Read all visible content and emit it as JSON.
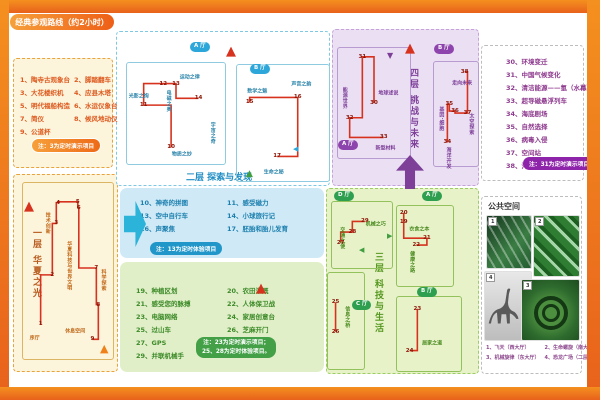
{
  "title": "经典参观路线（约2小时）",
  "colors": {
    "frame": "#e8611c",
    "route": "#d6321e",
    "blue": "#2da7d9",
    "green": "#2e9e4f",
    "purple": "#8e44ad",
    "orange": "#f08119"
  },
  "floor1": {
    "title": "一层 华夏之光",
    "items": [
      {
        "n": "1",
        "t": "陶寺古观象台"
      },
      {
        "n": "2",
        "t": "脚踏翻车"
      },
      {
        "n": "3",
        "t": "大花楼织机"
      },
      {
        "n": "4",
        "t": "应县木塔"
      },
      {
        "n": "5",
        "t": "明代福船构造"
      },
      {
        "n": "6",
        "t": "水运仪象台"
      },
      {
        "n": "7",
        "t": "简仪"
      },
      {
        "n": "8",
        "t": "候风地动仪"
      },
      {
        "n": "9",
        "t": "公道杯"
      }
    ],
    "note": "注：3为定时演示项目"
  },
  "floor2": {
    "title": "二层 探索与发现",
    "items": [
      {
        "n": "10",
        "t": "神奇的拼图"
      },
      {
        "n": "11",
        "t": "感受磁力"
      },
      {
        "n": "13",
        "t": "空中自行车"
      },
      {
        "n": "14",
        "t": "小球旅行记"
      },
      {
        "n": "16",
        "t": "声聚焦"
      },
      {
        "n": "17",
        "t": "胚胎和胎儿发育"
      }
    ],
    "note": "注：13为定时体验项目"
  },
  "floor3": {
    "title": "三层 科技与生活",
    "items": [
      {
        "n": "19",
        "t": "种植区划"
      },
      {
        "n": "20",
        "t": "农田灌溉"
      },
      {
        "n": "21",
        "t": "感受您的脉搏"
      },
      {
        "n": "22",
        "t": "人体保卫战"
      },
      {
        "n": "23",
        "t": "电脑网络"
      },
      {
        "n": "24",
        "t": "家居创意台"
      },
      {
        "n": "25",
        "t": "过山车"
      },
      {
        "n": "26",
        "t": "芝麻开门"
      },
      {
        "n": "27",
        "t": "GPS"
      },
      {
        "n": "28",
        "t": "螺旋推进器"
      },
      {
        "n": "29",
        "t": "并联机械手"
      }
    ],
    "note1": "注：23为定时演示项目；",
    "note2": "25、28为定时体验项目。"
  },
  "floor4": {
    "title": "四层 挑战与未来",
    "items": [
      {
        "n": "30",
        "t": "环境变迁"
      },
      {
        "n": "31",
        "t": "中国气候变化"
      },
      {
        "n": "32",
        "t": "清洁能源——氢（水幕）"
      },
      {
        "n": "33",
        "t": "超导磁悬浮列车"
      },
      {
        "n": "34",
        "t": "海底剧场"
      },
      {
        "n": "35",
        "t": "自然选择"
      },
      {
        "n": "36",
        "t": "病毒入侵"
      },
      {
        "n": "37",
        "t": "空间站"
      },
      {
        "n": "38",
        "t": "沟通世界"
      }
    ],
    "note": "注：31为定时演示项目"
  },
  "public_space": {
    "title": "公共空间",
    "captions": [
      "1、飞天（西大厅）",
      "2、生命螺旋（南大厅）",
      "3、机械旋律（东大厅）",
      "4、恐龙广场（二层中央大厅）"
    ],
    "photo_tags": [
      "1",
      "2",
      "4",
      "3"
    ]
  },
  "plans": [
    {
      "id": "f1",
      "stops": [
        {
          "n": "1",
          "x": 19.6,
          "y": 80.3
        },
        {
          "n": "2",
          "x": 32.6,
          "y": 52.2
        },
        {
          "n": "3",
          "x": 37,
          "y": 23
        },
        {
          "n": "4",
          "x": 39.1,
          "y": 11.2
        },
        {
          "n": "5",
          "x": 60.9,
          "y": 10.7
        },
        {
          "n": "6",
          "x": 62,
          "y": 14
        },
        {
          "n": "7",
          "x": 81.5,
          "y": 48.3
        },
        {
          "n": "8",
          "x": 83.7,
          "y": 69.1
        },
        {
          "n": "9",
          "x": 77.2,
          "y": 88.8
        }
      ],
      "labels": [
        {
          "t": "技术创新",
          "x": 28,
          "y": 23,
          "v": 1
        },
        {
          "t": "华夏科技与世界文明",
          "x": 52,
          "y": 47,
          "v": 1
        },
        {
          "t": "科学探索",
          "x": 90,
          "y": 55,
          "v": 1
        },
        {
          "t": "序厅",
          "x": 13,
          "y": 88
        },
        {
          "t": "休息空间",
          "x": 58,
          "y": 84
        }
      ]
    },
    {
      "id": "f2a",
      "stops": [
        {
          "n": "10",
          "x": 45,
          "y": 83.5
        },
        {
          "n": "11",
          "x": 17,
          "y": 41.7
        },
        {
          "n": "12",
          "x": 37,
          "y": 20.4
        },
        {
          "n": "13",
          "x": 50,
          "y": 20.4
        },
        {
          "n": "14",
          "x": 73,
          "y": 35
        }
      ],
      "labels": [
        {
          "t": "光影之绚",
          "x": 12,
          "y": 33
        },
        {
          "t": "电磁之奥",
          "x": 43,
          "y": 38,
          "v": 1
        },
        {
          "t": "运动之律",
          "x": 64,
          "y": 14
        },
        {
          "t": "宇宙之奇",
          "x": 88,
          "y": 69,
          "v": 1
        },
        {
          "t": "物质之妙",
          "x": 56,
          "y": 90
        }
      ]
    },
    {
      "id": "f2b",
      "stops": [
        {
          "n": "15",
          "x": 13.8,
          "y": 32.2
        },
        {
          "n": "16",
          "x": 66,
          "y": 28
        },
        {
          "n": "17",
          "x": 43.6,
          "y": 78.8
        }
      ],
      "labels": [
        {
          "t": "数学之魅",
          "x": 22,
          "y": 22
        },
        {
          "t": "声音之韵",
          "x": 70,
          "y": 16
        },
        {
          "t": "生命之秘",
          "x": 40,
          "y": 92
        }
      ]
    },
    {
      "id": "f3d",
      "stops": [
        {
          "n": "27",
          "x": 14.5,
          "y": 61.8
        },
        {
          "n": "28",
          "x": 33.9,
          "y": 45.6
        },
        {
          "n": "29",
          "x": 54.8,
          "y": 29.4
        }
      ],
      "labels": [
        {
          "t": "机械之巧",
          "x": 73,
          "y": 33
        },
        {
          "t": "交通之便",
          "x": 18,
          "y": 55,
          "v": 1
        }
      ]
    },
    {
      "id": "f3a",
      "stops": [
        {
          "n": "19",
          "x": 12,
          "y": 19.5
        },
        {
          "n": "20",
          "x": 12,
          "y": 8.5
        },
        {
          "n": "21",
          "x": 53.4,
          "y": 40.2
        },
        {
          "n": "22",
          "x": 34.5,
          "y": 48.8
        }
      ],
      "labels": [
        {
          "t": "衣食之本",
          "x": 40,
          "y": 29
        },
        {
          "t": "健康之路",
          "x": 28,
          "y": 70,
          "v": 1
        }
      ]
    },
    {
      "id": "f3b",
      "stops": [
        {
          "n": "23",
          "x": 31.8,
          "y": 15.8
        },
        {
          "n": "24",
          "x": 19.7,
          "y": 72.4
        }
      ],
      "labels": [
        {
          "t": "居家之道",
          "x": 55,
          "y": 62
        }
      ]
    },
    {
      "id": "f3c",
      "stops": [
        {
          "n": "25",
          "x": 21,
          "y": 30.6
        },
        {
          "n": "26",
          "x": 21,
          "y": 61.2
        }
      ],
      "labels": [
        {
          "t": "信息之桥",
          "x": 55,
          "y": 46,
          "v": 1
        }
      ]
    },
    {
      "id": "f4a",
      "stops": [
        {
          "n": "30",
          "x": 50,
          "y": 50
        },
        {
          "n": "31",
          "x": 33.8,
          "y": 8
        },
        {
          "n": "32",
          "x": 16.2,
          "y": 63.4
        },
        {
          "n": "33",
          "x": 63.5,
          "y": 81.3
        }
      ],
      "labels": [
        {
          "t": "能源世界",
          "x": 10,
          "y": 45,
          "v": 1
        },
        {
          "t": "地球述说",
          "x": 70,
          "y": 41
        },
        {
          "t": "新型材料",
          "x": 66,
          "y": 91
        }
      ]
    },
    {
      "id": "f4b",
      "stops": [
        {
          "n": "34",
          "x": 30.4,
          "y": 77.4
        },
        {
          "n": "35",
          "x": 34.8,
          "y": 40.6
        },
        {
          "n": "36",
          "x": 47.8,
          "y": 47.2
        },
        {
          "n": "37",
          "x": 76.1,
          "y": 49.1
        },
        {
          "n": "38",
          "x": 69.6,
          "y": 9.4
        }
      ],
      "labels": [
        {
          "t": "走向未来",
          "x": 64,
          "y": 20
        },
        {
          "t": "基因·细胞",
          "x": 18,
          "y": 55,
          "v": 1
        },
        {
          "t": "太空探索",
          "x": 86,
          "y": 60,
          "v": 1
        },
        {
          "t": "海洋开发",
          "x": 34,
          "y": 92,
          "v": 1
        }
      ]
    }
  ],
  "overlays": [
    {
      "cls": "badge bg-blue",
      "t": "A 厅",
      "x": 190,
      "y": 42,
      "name": "hall-badge-f2-a"
    },
    {
      "cls": "badge bg-blue",
      "t": "B 厅",
      "x": 250,
      "y": 64,
      "name": "hall-badge-f2-b"
    },
    {
      "cls": "badge bg-green",
      "t": "D 厅",
      "x": 334,
      "y": 191,
      "name": "hall-badge-f3-d"
    },
    {
      "cls": "badge bg-green",
      "t": "A 厅",
      "x": 422,
      "y": 191,
      "name": "hall-badge-f3-a"
    },
    {
      "cls": "badge bg-green",
      "t": "C 厅",
      "x": 352,
      "y": 300,
      "name": "hall-badge-f3-c"
    },
    {
      "cls": "badge bg-green",
      "t": "B 厅",
      "x": 417,
      "y": 287,
      "name": "hall-badge-f3-b"
    },
    {
      "cls": "badge bg-purple",
      "t": "A 厅",
      "x": 338,
      "y": 140,
      "name": "hall-badge-f4-a"
    },
    {
      "cls": "badge bg-purple",
      "t": "B 厅",
      "x": 434,
      "y": 44,
      "name": "hall-badge-f4-b"
    },
    {
      "cls": "compass",
      "t": "▲",
      "x": 24,
      "y": 200,
      "name": "compass-icon"
    },
    {
      "cls": "compass",
      "t": "▲",
      "x": 226,
      "y": 45,
      "name": "compass-icon"
    },
    {
      "cls": "compass",
      "t": "▲",
      "x": 405,
      "y": 42,
      "name": "compass-icon"
    },
    {
      "cls": "compass",
      "t": "▲",
      "x": 256,
      "y": 282,
      "name": "compass-icon"
    },
    {
      "cls": "tri",
      "t": "▲",
      "x": 100,
      "y": 343,
      "name": "entrance-triangle-icon",
      "c": "#f08119",
      "s": 11
    },
    {
      "cls": "tri",
      "t": "▲",
      "x": 246,
      "y": 170,
      "name": "flow-triangle-icon",
      "c": "#3f9e3f",
      "s": 9
    },
    {
      "cls": "tri",
      "t": "◀",
      "x": 293,
      "y": 146,
      "name": "flow-triangle-icon",
      "c": "#2da7d9",
      "s": 7
    },
    {
      "cls": "tri",
      "t": "▶",
      "x": 387,
      "y": 233,
      "name": "flow-triangle-icon",
      "c": "#3f9e3f",
      "s": 7
    },
    {
      "cls": "tri",
      "t": "◀",
      "x": 359,
      "y": 247,
      "name": "flow-triangle-icon",
      "c": "#3f9e3f",
      "s": 7
    },
    {
      "cls": "tri",
      "t": "▼",
      "x": 387,
      "y": 52,
      "name": "flow-triangle-icon",
      "c": "#7d3f98",
      "s": 8
    }
  ]
}
